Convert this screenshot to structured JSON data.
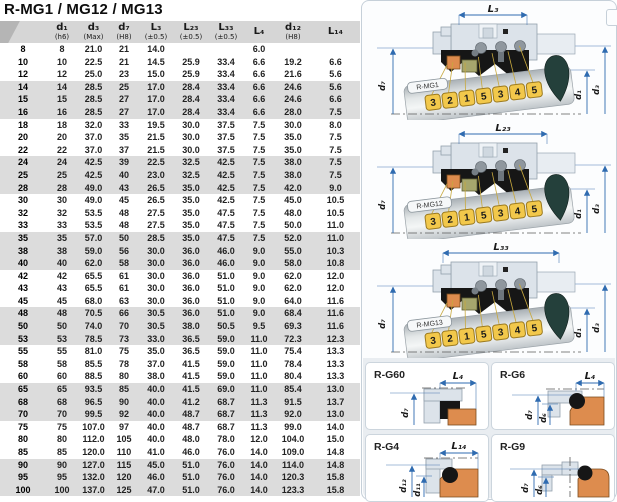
{
  "title": "R-MG1 / MG12 / MG13",
  "table": {
    "columns": [
      {
        "label": "",
        "note": ""
      },
      {
        "label": "d₁",
        "note": "(h6)"
      },
      {
        "label": "d₃",
        "note": "(Max)"
      },
      {
        "label": "d₇",
        "note": "(H8)"
      },
      {
        "label": "L₃",
        "note": "(±0.5)"
      },
      {
        "label": "L₂₃",
        "note": "(±0.5)"
      },
      {
        "label": "L₃₃",
        "note": "(±0.5)"
      },
      {
        "label": "L₄",
        "note": ""
      },
      {
        "label": "d₁₂",
        "note": "(H8)"
      },
      {
        "label": "L₁₄",
        "note": ""
      }
    ],
    "rows": [
      [
        "8",
        "8",
        "21.0",
        "21",
        "14.0",
        "",
        "",
        "6.0",
        "",
        ""
      ],
      [
        "10",
        "10",
        "22.5",
        "21",
        "14.5",
        "25.9",
        "33.4",
        "6.6",
        "19.2",
        "6.6"
      ],
      [
        "12",
        "12",
        "25.0",
        "23",
        "15.0",
        "25.9",
        "33.4",
        "6.6",
        "21.6",
        "5.6"
      ],
      [
        "14",
        "14",
        "28.5",
        "25",
        "17.0",
        "28.4",
        "33.4",
        "6.6",
        "24.6",
        "5.6"
      ],
      [
        "15",
        "15",
        "28.5",
        "27",
        "17.0",
        "28.4",
        "33.4",
        "6.6",
        "24.6",
        "6.6"
      ],
      [
        "16",
        "16",
        "28.5",
        "27",
        "17.0",
        "28.4",
        "33.4",
        "6.6",
        "28.0",
        "7.5"
      ],
      [
        "18",
        "18",
        "32.0",
        "33",
        "19.5",
        "30.0",
        "37.5",
        "7.5",
        "30.0",
        "8.0"
      ],
      [
        "20",
        "20",
        "37.0",
        "35",
        "21.5",
        "30.0",
        "37.5",
        "7.5",
        "35.0",
        "7.5"
      ],
      [
        "22",
        "22",
        "37.0",
        "37",
        "21.5",
        "30.0",
        "37.5",
        "7.5",
        "35.0",
        "7.5"
      ],
      [
        "24",
        "24",
        "42.5",
        "39",
        "22.5",
        "32.5",
        "42.5",
        "7.5",
        "38.0",
        "7.5"
      ],
      [
        "25",
        "25",
        "42.5",
        "40",
        "23.0",
        "32.5",
        "42.5",
        "7.5",
        "38.0",
        "7.5"
      ],
      [
        "28",
        "28",
        "49.0",
        "43",
        "26.5",
        "35.0",
        "42.5",
        "7.5",
        "42.0",
        "9.0"
      ],
      [
        "30",
        "30",
        "49.0",
        "45",
        "26.5",
        "35.0",
        "42.5",
        "7.5",
        "45.0",
        "10.5"
      ],
      [
        "32",
        "32",
        "53.5",
        "48",
        "27.5",
        "35.0",
        "47.5",
        "7.5",
        "48.0",
        "10.5"
      ],
      [
        "33",
        "33",
        "53.5",
        "48",
        "27.5",
        "35.0",
        "47.5",
        "7.5",
        "50.0",
        "11.0"
      ],
      [
        "35",
        "35",
        "57.0",
        "50",
        "28.5",
        "35.0",
        "47.5",
        "7.5",
        "52.0",
        "11.0"
      ],
      [
        "38",
        "38",
        "59.0",
        "56",
        "30.0",
        "36.0",
        "46.0",
        "9.0",
        "55.0",
        "10.3"
      ],
      [
        "40",
        "40",
        "62.0",
        "58",
        "30.0",
        "36.0",
        "46.0",
        "9.0",
        "58.0",
        "10.8"
      ],
      [
        "42",
        "42",
        "65.5",
        "61",
        "30.0",
        "36.0",
        "51.0",
        "9.0",
        "62.0",
        "12.0"
      ],
      [
        "43",
        "43",
        "65.5",
        "61",
        "30.0",
        "36.0",
        "51.0",
        "9.0",
        "62.0",
        "12.0"
      ],
      [
        "45",
        "45",
        "68.0",
        "63",
        "30.0",
        "36.0",
        "51.0",
        "9.0",
        "64.0",
        "11.6"
      ],
      [
        "48",
        "48",
        "70.5",
        "66",
        "30.5",
        "36.0",
        "51.0",
        "9.0",
        "68.4",
        "11.6"
      ],
      [
        "50",
        "50",
        "74.0",
        "70",
        "30.5",
        "38.0",
        "50.5",
        "9.5",
        "69.3",
        "11.6"
      ],
      [
        "53",
        "53",
        "78.5",
        "73",
        "33.0",
        "36.5",
        "59.0",
        "11.0",
        "72.3",
        "12.3"
      ],
      [
        "55",
        "55",
        "81.0",
        "75",
        "35.0",
        "36.5",
        "59.0",
        "11.0",
        "75.4",
        "13.3"
      ],
      [
        "58",
        "58",
        "85.5",
        "78",
        "37.0",
        "41.5",
        "59.0",
        "11.0",
        "78.4",
        "13.3"
      ],
      [
        "60",
        "60",
        "88.5",
        "80",
        "38.0",
        "41.5",
        "59.0",
        "11.0",
        "80.4",
        "13.3"
      ],
      [
        "65",
        "65",
        "93.5",
        "85",
        "40.0",
        "41.5",
        "69.0",
        "11.0",
        "85.4",
        "13.0"
      ],
      [
        "68",
        "68",
        "96.5",
        "90",
        "40.0",
        "41.2",
        "68.7",
        "11.3",
        "91.5",
        "13.7"
      ],
      [
        "70",
        "70",
        "99.5",
        "92",
        "40.0",
        "48.7",
        "68.7",
        "11.3",
        "92.0",
        "13.0"
      ],
      [
        "75",
        "75",
        "107.0",
        "97",
        "40.0",
        "48.7",
        "68.7",
        "11.3",
        "99.0",
        "14.0"
      ],
      [
        "80",
        "80",
        "112.0",
        "105",
        "40.0",
        "48.0",
        "78.0",
        "12.0",
        "104.0",
        "15.0"
      ],
      [
        "85",
        "85",
        "120.0",
        "110",
        "41.0",
        "46.0",
        "76.0",
        "14.0",
        "109.0",
        "14.8"
      ],
      [
        "90",
        "90",
        "127.0",
        "115",
        "45.0",
        "51.0",
        "76.0",
        "14.0",
        "114.0",
        "14.8"
      ],
      [
        "95",
        "95",
        "132.0",
        "120",
        "46.0",
        "51.0",
        "76.0",
        "14.0",
        "120.3",
        "15.8"
      ],
      [
        "100",
        "100",
        "137.0",
        "125",
        "47.0",
        "51.0",
        "76.0",
        "14.0",
        "123.3",
        "15.8"
      ]
    ]
  },
  "diagrams": [
    {
      "tag": "R-MG1",
      "dim_top": "L₃"
    },
    {
      "tag": "R-MG12",
      "dim_top": "L₂₃"
    },
    {
      "tag": "R-MG13",
      "dim_top": "L₃₃"
    }
  ],
  "callout_sequence": [
    "3",
    "2",
    "1",
    "5",
    "3",
    "4",
    "5"
  ],
  "dim_labels": {
    "d7": "d₇",
    "d1": "d₁",
    "d3": "d₃"
  },
  "detail_views": [
    {
      "name": "R-G60",
      "dims": {
        "top": "L₄",
        "left1": "d₇",
        "left2": ""
      }
    },
    {
      "name": "R-G6",
      "dims": {
        "top": "L₄",
        "left1": "d₇",
        "left2": "d₆"
      }
    },
    {
      "name": "R-G4",
      "dims": {
        "top": "L₁₄",
        "left1": "d₁₂",
        "left2": "d₁₁"
      }
    },
    {
      "name": "R-G9",
      "dims": {
        "top": "",
        "left1": "d₇",
        "left2": "d₆"
      }
    }
  ],
  "colors": {
    "dimension_blue": "#2f6bb0",
    "callout_yellow": "#f2c84b",
    "seat_orange": "#dd8c4e",
    "ring_olive": "#a6a66d",
    "housing_gray_blue": "#dce3ea",
    "rubber_black": "#161616",
    "shaft_tip_dark": "#24403b",
    "header_gray": "#d6d6d6",
    "row_band_gray": "#dcdcdc"
  }
}
